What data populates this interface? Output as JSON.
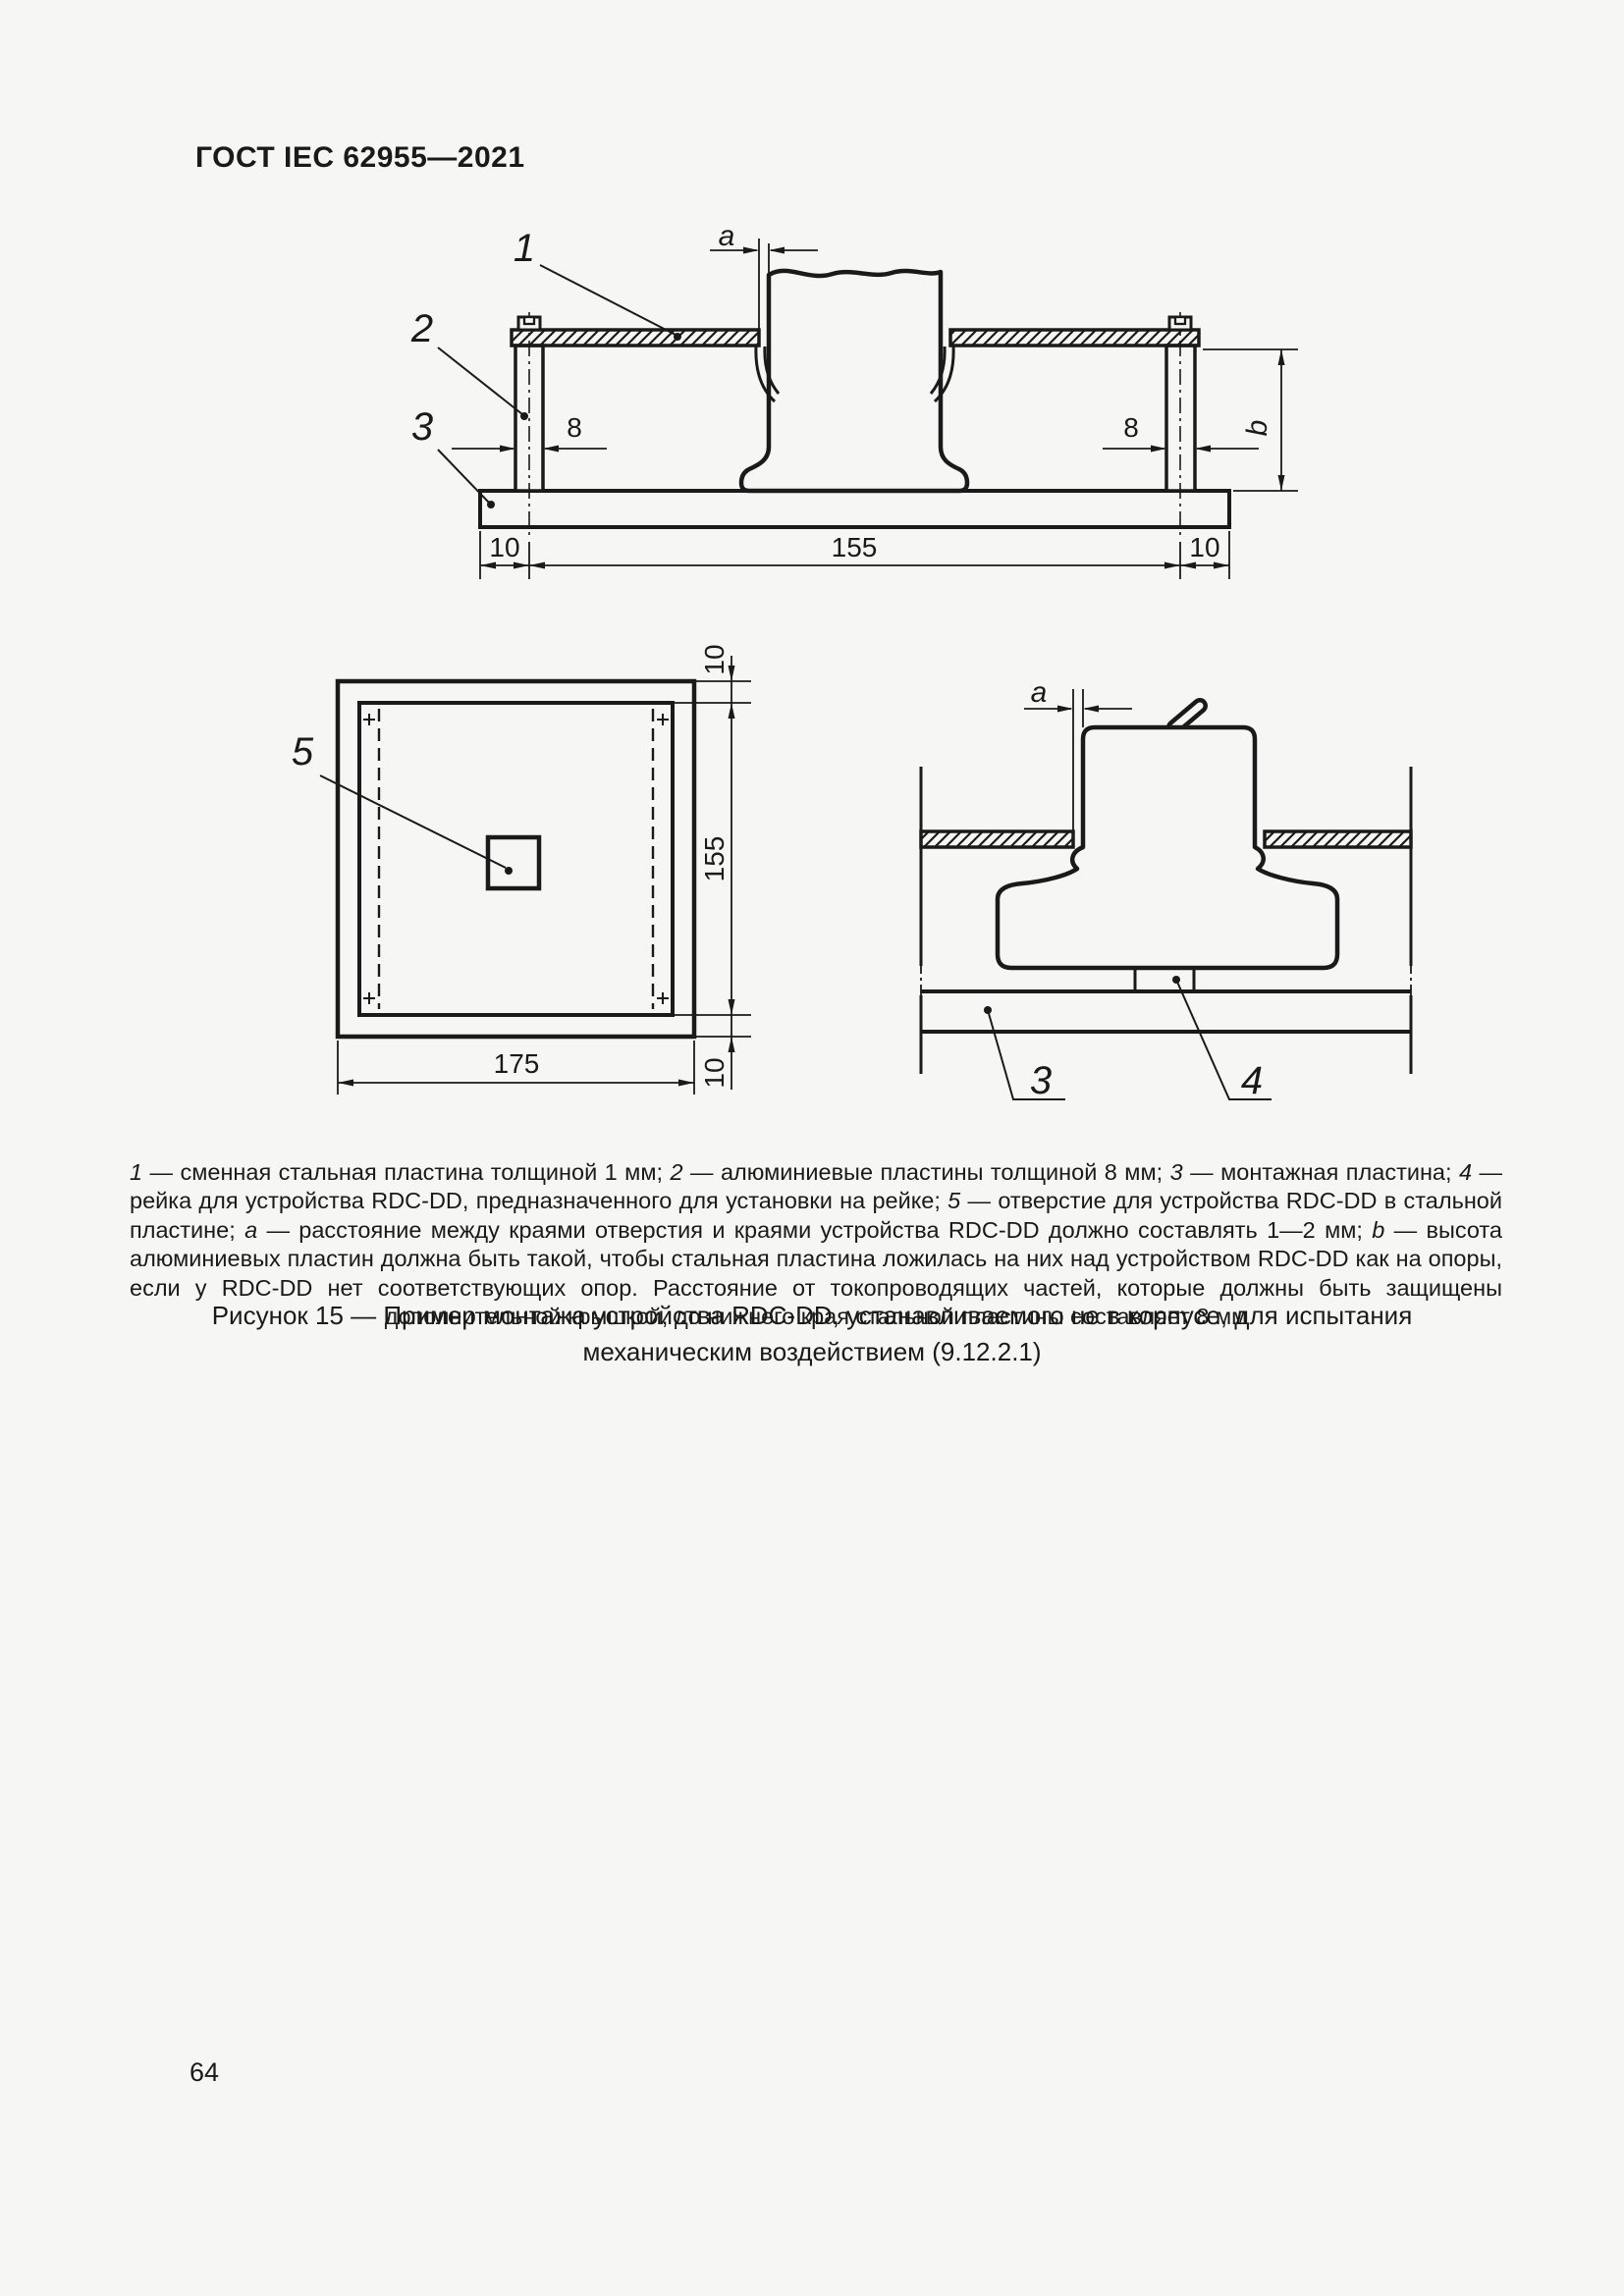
{
  "page": {
    "header": "ГОСТ IEC 62955—2021",
    "page_number": "64"
  },
  "figure": {
    "caption_line1": "Рисунок 15 — Пример монтажа устройства RDC-DD, устанавливаемого не в корпусе, для испытания",
    "caption_line2": "механическим воздействием (9.12.2.1)",
    "legend_runs": [
      {
        "t": "1",
        "i": 1
      },
      {
        "t": " — сменная стальная пластина толщиной 1 мм; ",
        "i": 0
      },
      {
        "t": "2",
        "i": 1
      },
      {
        "t": " — алюминиевые пластины толщиной 8 мм; ",
        "i": 0
      },
      {
        "t": "3",
        "i": 1
      },
      {
        "t": " — монтажная пластина; ",
        "i": 0
      },
      {
        "t": "4",
        "i": 1
      },
      {
        "t": " — рейка для устройства RDC-DD, предназначенного для установки на рейке; ",
        "i": 0
      },
      {
        "t": "5",
        "i": 1
      },
      {
        "t": " — отверстие для устройства RDC-DD в стальной пластине; ",
        "i": 0
      },
      {
        "t": "a",
        "i": 1
      },
      {
        "t": " — расстояние между краями отверстия и краями устройства RDC-DD должно составлять 1—2 мм; ",
        "i": 0
      },
      {
        "t": "b",
        "i": 1
      },
      {
        "t": " — высота алюминиевых пластин должна быть такой, чтобы стальная пластина ложилась на них над устройством RDC-DD как на опоры, если у RDC-DD нет соответствующих опор. Расстояние от токопроводящих частей, которые должны быть защищены дополнительной крышкой, до нижнего края стальной пластины составляет 8 мм",
        "i": 0
      }
    ]
  },
  "top_view": {
    "part_labels": {
      "p1": "1",
      "p2": "2",
      "p3": "3"
    },
    "dims": {
      "a": "a",
      "b": "b",
      "w8_left": "8",
      "w8_right": "8",
      "m10_left": "10",
      "m155": "155",
      "m10_right": "10"
    }
  },
  "plate_view": {
    "part_labels": {
      "p5": "5"
    },
    "dims": {
      "m10_top": "10",
      "m155": "155",
      "m10_bottom": "10",
      "m175": "175"
    }
  },
  "side_view": {
    "part_labels": {
      "p3": "3",
      "p4": "4"
    },
    "dims": {
      "a": "a"
    }
  },
  "colors": {
    "ink": "#1a1a1a",
    "background": "#f6f6f4"
  }
}
